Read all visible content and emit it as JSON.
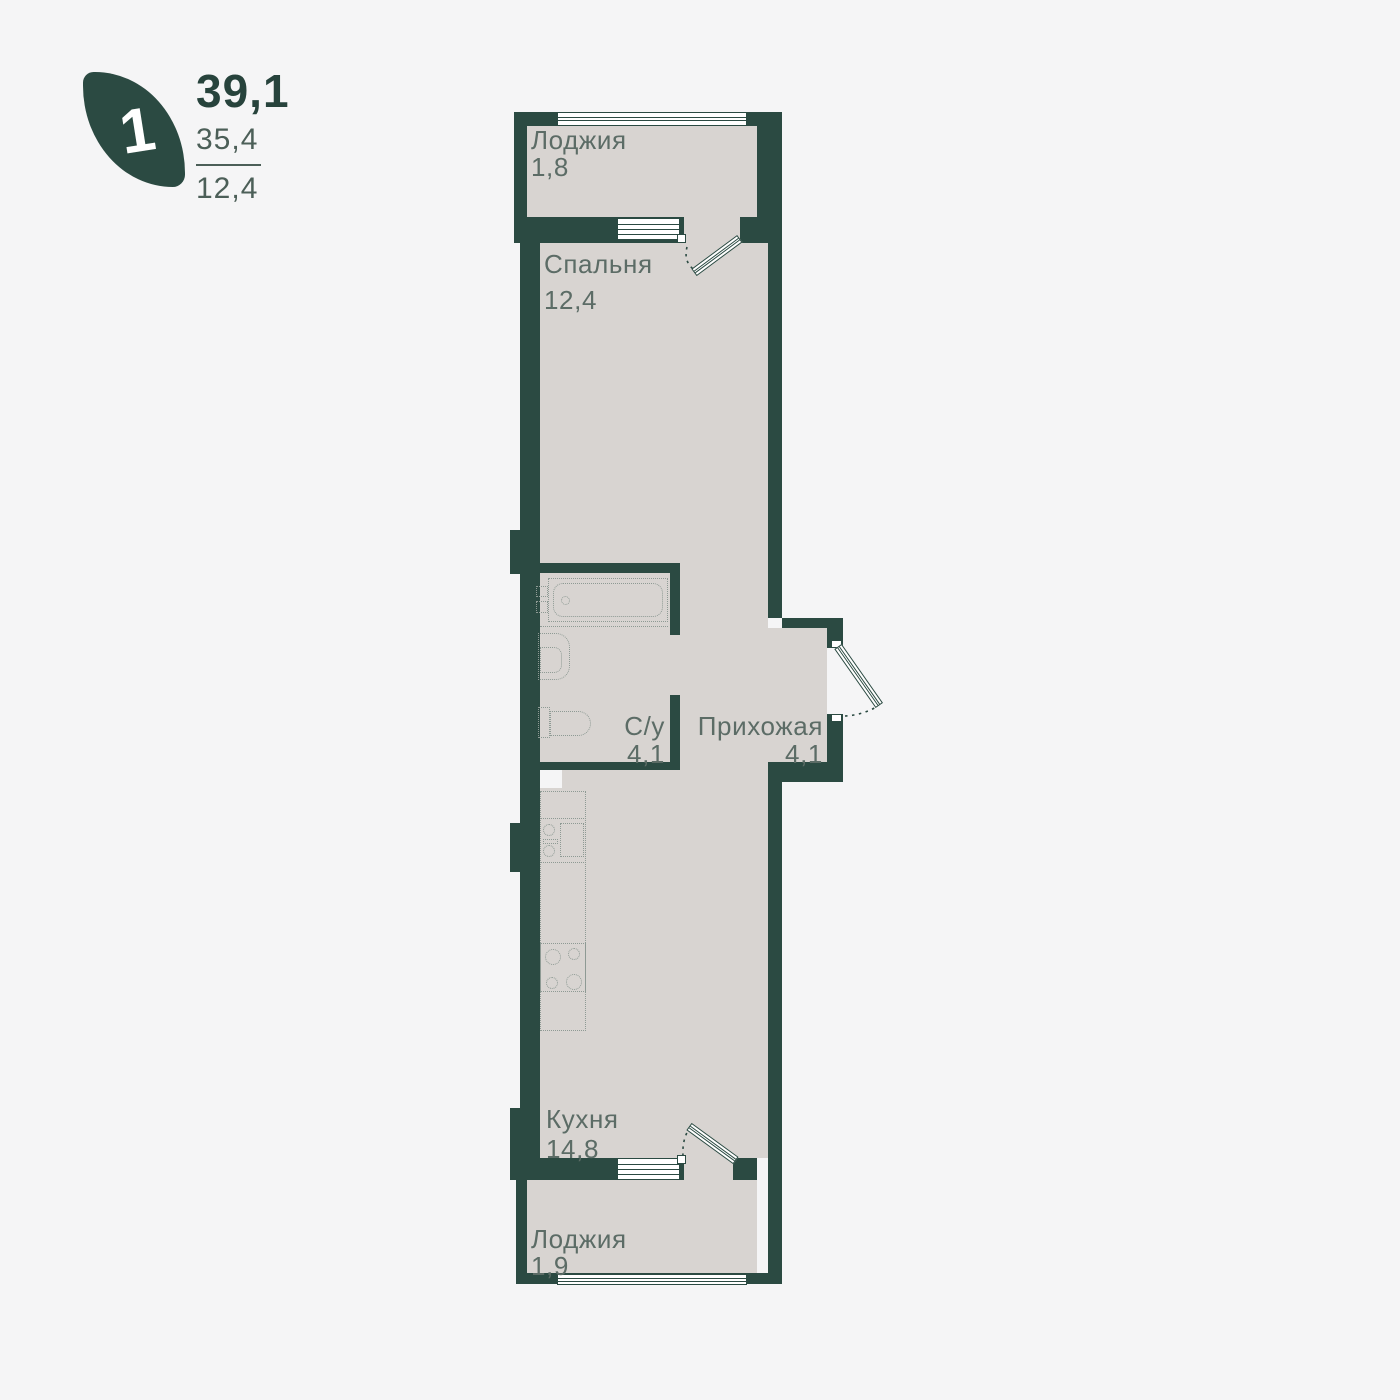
{
  "header": {
    "rooms_badge": "1",
    "total_area": "39,1",
    "living_area": "35,4",
    "room_area": "12,4"
  },
  "rooms": [
    {
      "name": "Лоджия",
      "area": "1,8"
    },
    {
      "name": "Спальня",
      "area": "12,4"
    },
    {
      "name": "С/у",
      "area": "4,1"
    },
    {
      "name": "Прихожая",
      "area": "4,1"
    },
    {
      "name": "Кухня",
      "area": "14,8"
    },
    {
      "name": "Лоджия",
      "area": "1,9"
    }
  ],
  "colors": {
    "wall": "#2b4a42",
    "floor": "#d8d4d1",
    "background": "#f5f5f6",
    "label_text": "#5c6c66",
    "accent_text": "#27433c",
    "secondary_text": "#4c5f58",
    "fixture_outline": "#8e9a94",
    "window_fill": "#ffffff"
  }
}
